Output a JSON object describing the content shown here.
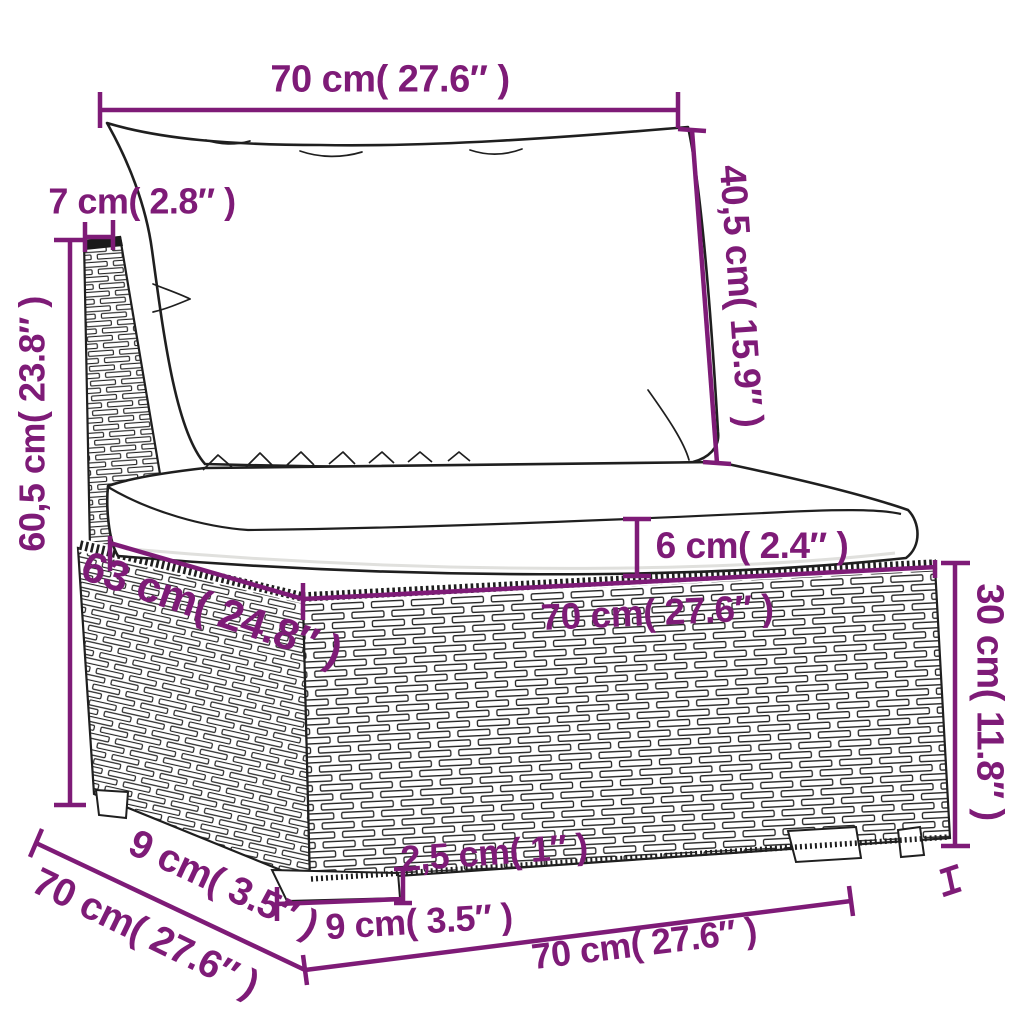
{
  "diagram": {
    "subject": "poly-rattan garden sofa middle section with cushions — dimension drawing",
    "background": "#ffffff",
    "colors": {
      "dimension": "#7e1b77",
      "outline": "#1f1f1f",
      "cushion_fill": "#ffffff"
    },
    "dimensions": {
      "back_cushion_width": {
        "cm": "70",
        "label": "70 cm( 27.6″ )"
      },
      "back_post_depth": {
        "cm": "7",
        "label": "7 cm( 2.8″ )"
      },
      "back_cushion_height": {
        "cm": "40,5",
        "label": "40,5 cm( 15.9″ )"
      },
      "total_height": {
        "cm": "60,5",
        "label": "60,5 cm( 23.8″ )"
      },
      "seat_depth": {
        "cm": "63",
        "label": "63 cm( 24.8″ )"
      },
      "seat_width": {
        "cm": "70",
        "label": "70 cm( 27.6″ )"
      },
      "seat_cushion_thickness": {
        "cm": "6",
        "label": "6 cm( 2.4″ )"
      },
      "base_height": {
        "cm": "30",
        "label": "30 cm( 11.8″ )"
      },
      "leg_depth": {
        "cm": "9",
        "label": "9 cm( 3.5″ )"
      },
      "total_depth": {
        "cm": "70",
        "label": "70 cm( 27.6″ )"
      },
      "leg_width": {
        "cm": "9",
        "label": "9 cm( 3.5″ )"
      },
      "leg_height": {
        "cm": "2,5",
        "label": "2,5 cm( 1″ )"
      },
      "total_width": {
        "cm": "70",
        "label": "70 cm( 27.6″ )"
      }
    }
  }
}
